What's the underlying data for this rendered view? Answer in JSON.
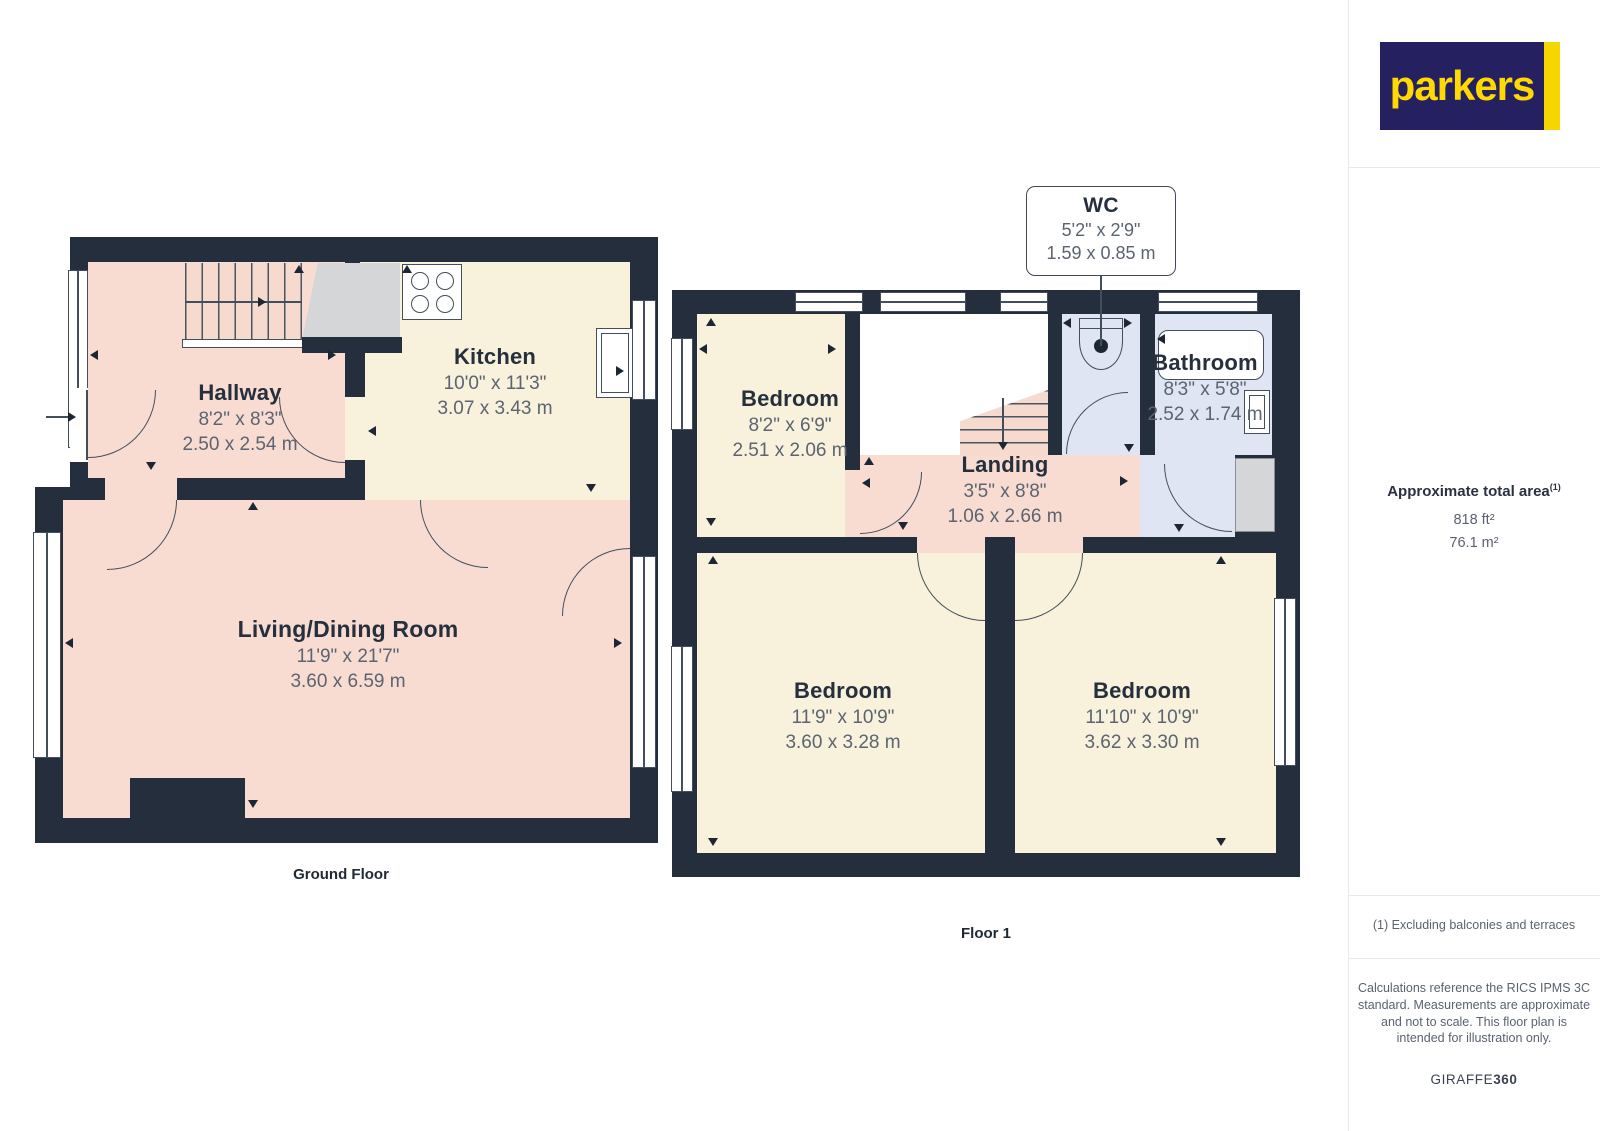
{
  "colors": {
    "wall": "#242e3c",
    "room_pink": "#f8dcd2",
    "room_cream": "#f8f1dc",
    "room_blue": "#dfe5f2",
    "understair_gray": "#d5d6d8",
    "logo_navy": "#252060",
    "logo_yellow": "#ffd900"
  },
  "logo": {
    "text": "parkers"
  },
  "ground_floor": {
    "caption": "Ground Floor",
    "hallway": {
      "name": "Hallway",
      "imperial": "8'2\" x 8'3\"",
      "metric": "2.50 x 2.54 m"
    },
    "kitchen": {
      "name": "Kitchen",
      "imperial": "10'0\" x 11'3\"",
      "metric": "3.07 x 3.43 m"
    },
    "living": {
      "name": "Living/Dining Room",
      "imperial": "11'9\" x 21'7\"",
      "metric": "3.60 x 6.59 m"
    }
  },
  "floor1": {
    "caption": "Floor 1",
    "bedroom_top": {
      "name": "Bedroom",
      "imperial": "8'2\" x 6'9\"",
      "metric": "2.51 x 2.06 m"
    },
    "wc": {
      "name": "WC",
      "imperial": "5'2\" x 2'9\"",
      "metric": "1.59 x 0.85 m"
    },
    "bathroom": {
      "name": "Bathroom",
      "imperial": "8'3\" x 5'8\"",
      "metric": "2.52 x 1.74 m"
    },
    "landing": {
      "name": "Landing",
      "imperial": "3'5\" x 8'8\"",
      "metric": "1.06 x 2.66 m"
    },
    "bedroom_left": {
      "name": "Bedroom",
      "imperial": "11'9\" x 10'9\"",
      "metric": "3.60 x 3.28 m"
    },
    "bedroom_right": {
      "name": "Bedroom",
      "imperial": "11'10\" x 10'9\"",
      "metric": "3.62 x 3.30 m"
    }
  },
  "sidebar": {
    "total_area_label": "Approximate total area",
    "total_area_sup": "(1)",
    "area_imperial": "818 ft²",
    "area_metric": "76.1 m²",
    "footnote": "(1) Excluding balconies and terraces",
    "disclaimer": "Calculations reference the RICS IPMS 3C standard. Measurements are approximate and not to scale. This floor plan is intended for illustration only.",
    "credit_main": "GIRAFFE",
    "credit_bold": "360"
  }
}
